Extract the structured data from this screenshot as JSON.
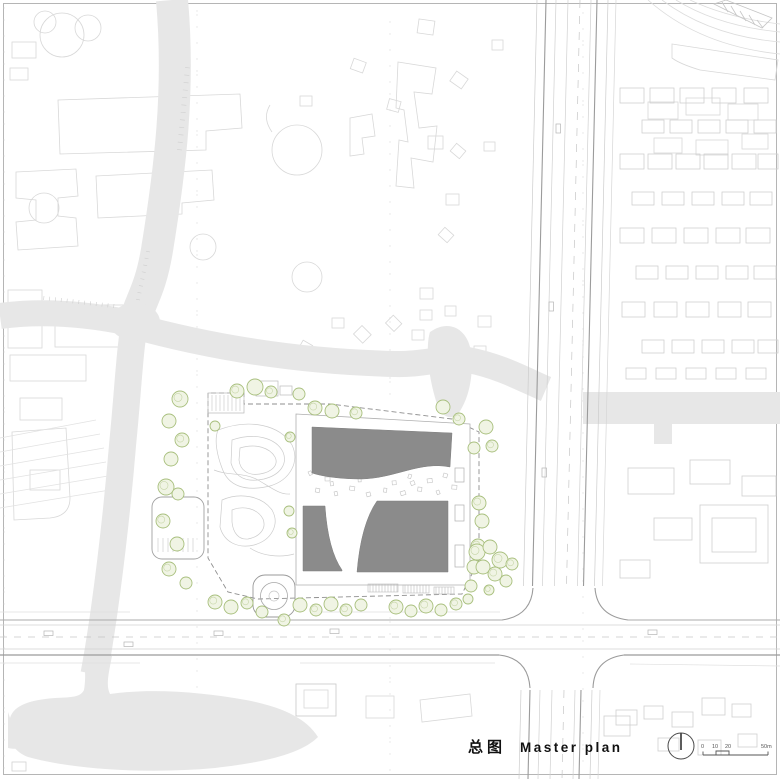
{
  "drawing": {
    "title_zh": "总图",
    "title_en": "Master plan"
  },
  "scale_bar": {
    "labels": [
      "0",
      "10",
      "20",
      "50m"
    ]
  },
  "north_arrow": {
    "icon": "north-arrow-icon"
  },
  "colors": {
    "roof_gray": "#8b8b8b",
    "water_gray": "#e7e7e7",
    "tree_green": "#a8bf7d",
    "tree_fill": "#f0f4e4",
    "road_dark": "#9b9b9b",
    "context_light": "#d8d8d8",
    "title_color": "#111111"
  }
}
